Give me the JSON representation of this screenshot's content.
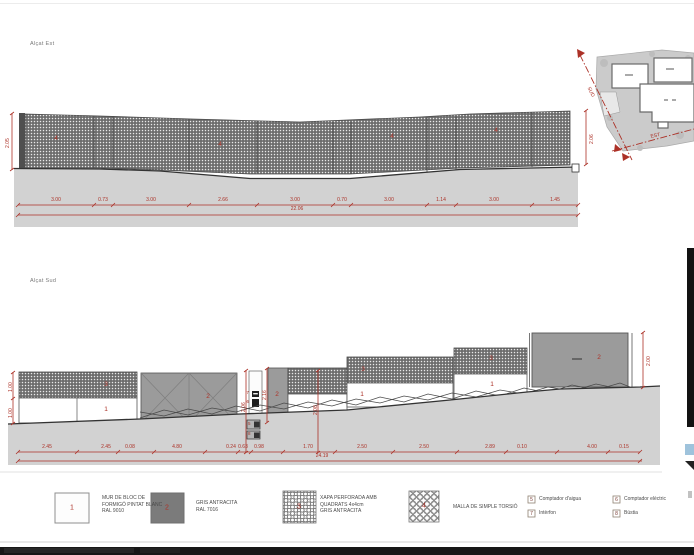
{
  "titles": {
    "east": "Alçat Est",
    "south": "Alçat Sud"
  },
  "east": {
    "panel_labels": [
      "4",
      "4",
      "4",
      "4"
    ],
    "height_left": "2.05",
    "height_right": "2.06",
    "dims": [
      "3.00",
      "0.73",
      "3.00",
      "2.66",
      "3.00",
      "0.70",
      "3.00",
      "1.14",
      "3.00",
      "1.45"
    ],
    "total": "22.06"
  },
  "south": {
    "material_labels": {
      "band1": "3",
      "wall1": "1",
      "gate1": "2",
      "gate2": "2",
      "band2": "3",
      "wall2": "1",
      "band3": "3",
      "wall3": "1",
      "gate3": "2"
    },
    "meter_labels": {
      "intercom": "7",
      "electric": "6",
      "water": "5",
      "mailbox": "8"
    },
    "heights": {
      "left_top": "1.00",
      "left_bottom": "1.00",
      "pillar": "2.06",
      "gate2": "2.16",
      "band": "2.08",
      "gate3": "2.00"
    },
    "dims": [
      "2.45",
      "2.45",
      "0.08",
      "4.80",
      "0.24",
      "0.63",
      "0.98",
      "1.70",
      "2.50",
      "2.50",
      "2.89",
      "0.10",
      "4.00",
      "0.15"
    ],
    "total": "24.19"
  },
  "site_plan": {
    "section_sud": "SUD",
    "section_est": "EST"
  },
  "legend": {
    "items": [
      {
        "num": "1",
        "text": "MUR DE BLOC DE\nFORMIGÓ PINTAT BLANC\nRAL 9010"
      },
      {
        "num": "2",
        "text": "GRIS ANTRACITA\nRAL 7016"
      },
      {
        "num": "3",
        "text": "XAPA PERFORADA AMB\nQUADRATS 4x4cm\nGRIS ANTRACITA"
      },
      {
        "num": "4",
        "text": "MALLA DE SIMPLE TORSIÓ"
      }
    ],
    "meters": [
      {
        "num": "5",
        "label": "Comptador d'aigua"
      },
      {
        "num": "7",
        "label": "Intèrfon"
      },
      {
        "num": "6",
        "label": "Comptador elèctric"
      },
      {
        "num": "8",
        "label": "Bústia"
      }
    ]
  },
  "colors": {
    "dim_red": "#ac3127",
    "ground_gray": "#d2d2d2",
    "gate_gray": "#9b9b9b",
    "band_gray": "#6d6d6d",
    "legend_dark": "#7b7b7b"
  }
}
